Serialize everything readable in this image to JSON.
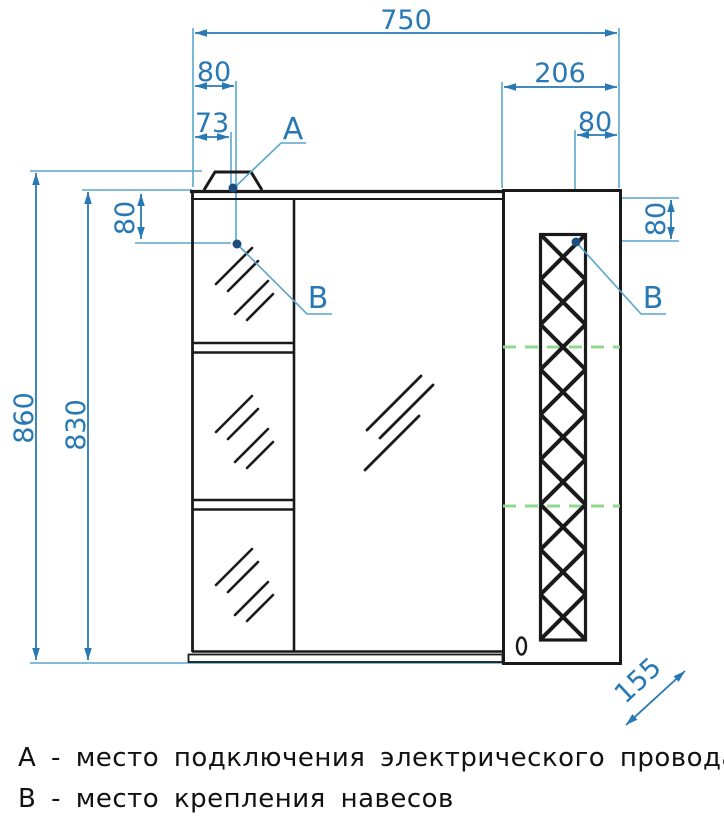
{
  "labels": {
    "a": "А",
    "b": "В"
  },
  "dims": {
    "total_width": "750",
    "top_offset_80": "80",
    "wire_offset_73": "73",
    "door_width_206": "206",
    "right_offset_80": "80",
    "total_height_860": "860",
    "body_height_830": "830",
    "left_drop_80": "80",
    "right_drop_80": "80",
    "depth_155": "155"
  },
  "legend": {
    "line_a": "А - место подключения электрического провода",
    "line_b": "В - место крепления навесов"
  },
  "colors": {
    "outline": "#1a1a1a",
    "dimension": "#2878b4",
    "extension": "#58a6cb",
    "point": "#1d4e7d",
    "shelf_marker_green": "#90d890",
    "background": "#ffffff"
  }
}
